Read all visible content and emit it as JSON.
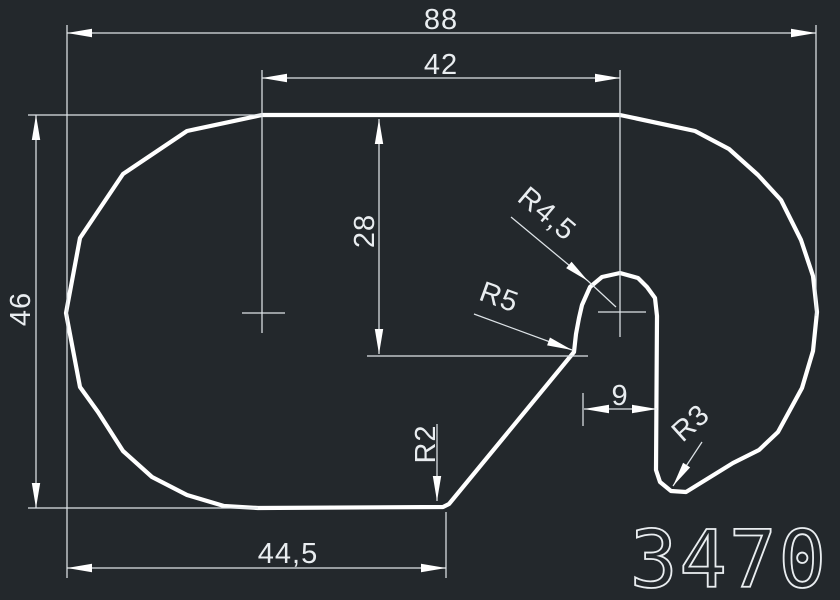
{
  "canvas": {
    "width": 840,
    "height": 600,
    "bg_color": "#23282c",
    "outline_color": "#ffffff",
    "thin_color": "#dde3e7",
    "text_color": "#e9edf0",
    "outline_width": 4.2,
    "thin_width": 1.25
  },
  "part_number": {
    "text": "3470",
    "x": 729,
    "y": 587,
    "size": 79
  },
  "chart_data": {
    "type": "cad_profile",
    "title": "Profile 3470 outline with dimensions",
    "dimensions_mm": {
      "overall_width": 88,
      "overall_height": 46,
      "top_flat_width": 42,
      "tab_depth_from_top": 28,
      "bottom_flat_width": 44.5,
      "slot_width": 9,
      "radii": {
        "tab_top": 4.5,
        "tab_base_fillet": 5,
        "bottom_corner": 2,
        "hook_bottom": 3
      }
    }
  },
  "outline_points": [
    [
      262,
      115
    ],
    [
      620,
      115
    ],
    [
      695,
      131
    ],
    [
      729,
      149
    ],
    [
      758,
      175
    ],
    [
      781,
      200
    ],
    [
      801,
      240
    ],
    [
      813,
      276
    ],
    [
      817,
      312
    ],
    [
      813,
      351
    ],
    [
      802,
      388
    ],
    [
      778,
      432
    ],
    [
      759,
      450
    ],
    [
      733,
      463
    ],
    [
      686,
      492
    ],
    [
      671,
      491
    ],
    [
      660,
      482
    ],
    [
      656,
      470
    ],
    [
      657,
      316
    ],
    [
      655,
      298
    ],
    [
      647,
      287
    ],
    [
      638,
      278
    ],
    [
      620,
      273
    ],
    [
      602,
      277
    ],
    [
      590,
      287
    ],
    [
      582,
      305
    ],
    [
      579,
      318
    ],
    [
      576,
      334
    ],
    [
      574,
      352
    ],
    [
      449,
      504
    ],
    [
      443,
      507
    ],
    [
      258,
      508
    ],
    [
      224,
      506
    ],
    [
      187,
      495
    ],
    [
      152,
      477
    ],
    [
      123,
      451
    ],
    [
      98,
      412
    ],
    [
      80,
      387
    ],
    [
      66,
      313
    ],
    [
      80,
      238
    ],
    [
      123,
      174
    ],
    [
      187,
      131
    ]
  ],
  "extension_lines": [
    [
      67,
      25,
      67,
      578
    ],
    [
      816,
      25,
      816,
      316
    ],
    [
      262,
      70,
      262,
      333
    ],
    [
      620,
      70,
      620,
      337
    ],
    [
      28,
      115,
      262,
      115
    ],
    [
      28,
      508,
      258,
      508
    ],
    [
      367,
      356,
      588,
      356
    ],
    [
      446,
      512,
      446,
      578
    ],
    [
      583,
      393,
      583,
      426
    ],
    [
      242,
      313,
      285,
      313
    ],
    [
      598,
      312,
      646,
      312
    ]
  ],
  "dimension_lines": [
    [
      67,
      33,
      816,
      33
    ],
    [
      262,
      78,
      620,
      78
    ],
    [
      36,
      115,
      36,
      508
    ],
    [
      67,
      568,
      446,
      568
    ],
    [
      379,
      119,
      379,
      354
    ],
    [
      584,
      409,
      657,
      409
    ]
  ],
  "leader_lines": [
    [
      [
        511,
        217
      ],
      [
        588,
        281
      ],
      [
        616,
        307
      ]
    ],
    [
      [
        474,
        314
      ],
      [
        572,
        350
      ]
    ],
    [
      [
        437,
        424
      ],
      [
        437,
        501
      ]
    ],
    [
      [
        702,
        442
      ],
      [
        673,
        486
      ]
    ]
  ],
  "arrows": [
    {
      "tip": [
        67,
        33
      ],
      "angle": 180
    },
    {
      "tip": [
        816,
        33
      ],
      "angle": 0
    },
    {
      "tip": [
        262,
        78
      ],
      "angle": 180
    },
    {
      "tip": [
        620,
        78
      ],
      "angle": 0
    },
    {
      "tip": [
        36,
        115
      ],
      "angle": 270
    },
    {
      "tip": [
        36,
        508
      ],
      "angle": 90
    },
    {
      "tip": [
        67,
        568
      ],
      "angle": 180
    },
    {
      "tip": [
        446,
        568
      ],
      "angle": 0
    },
    {
      "tip": [
        379,
        119
      ],
      "angle": 270
    },
    {
      "tip": [
        379,
        354
      ],
      "angle": 90
    },
    {
      "tip": [
        584,
        409
      ],
      "angle": 180
    },
    {
      "tip": [
        657,
        409
      ],
      "angle": 0
    },
    {
      "tip": [
        588,
        281
      ],
      "angle": 40
    },
    {
      "tip": [
        572,
        350
      ],
      "angle": 20
    },
    {
      "tip": [
        437,
        501
      ],
      "angle": 90
    },
    {
      "tip": [
        673,
        486
      ],
      "angle": 123
    }
  ],
  "labels": [
    {
      "name": "dim-overall-width-label",
      "text": "88",
      "x": 441,
      "y": 29,
      "rot": 0
    },
    {
      "name": "dim-top-flat-label",
      "text": "42",
      "x": 441,
      "y": 74,
      "rot": 0
    },
    {
      "name": "dim-overall-height-label",
      "text": "46",
      "x": 30,
      "y": 309,
      "rot": -90
    },
    {
      "name": "dim-tab-depth-label",
      "text": "28",
      "x": 374,
      "y": 231,
      "rot": -90
    },
    {
      "name": "dim-bottom-flat-label",
      "text": "44,5",
      "x": 288,
      "y": 563,
      "rot": 0
    },
    {
      "name": "dim-slot-width-label",
      "text": "9",
      "x": 620,
      "y": 405,
      "rot": 0
    },
    {
      "name": "radius-tab-top-label",
      "text": "R4,5",
      "x": 541,
      "y": 221,
      "rot": 40
    },
    {
      "name": "radius-tab-base-label",
      "text": "R5",
      "x": 496,
      "y": 306,
      "rot": 20
    },
    {
      "name": "radius-bottom-corner-label",
      "text": "R2",
      "x": 435,
      "y": 444,
      "rot": -90
    },
    {
      "name": "radius-hook-bottom-label",
      "text": "R3",
      "x": 697,
      "y": 430,
      "rot": -42
    }
  ]
}
